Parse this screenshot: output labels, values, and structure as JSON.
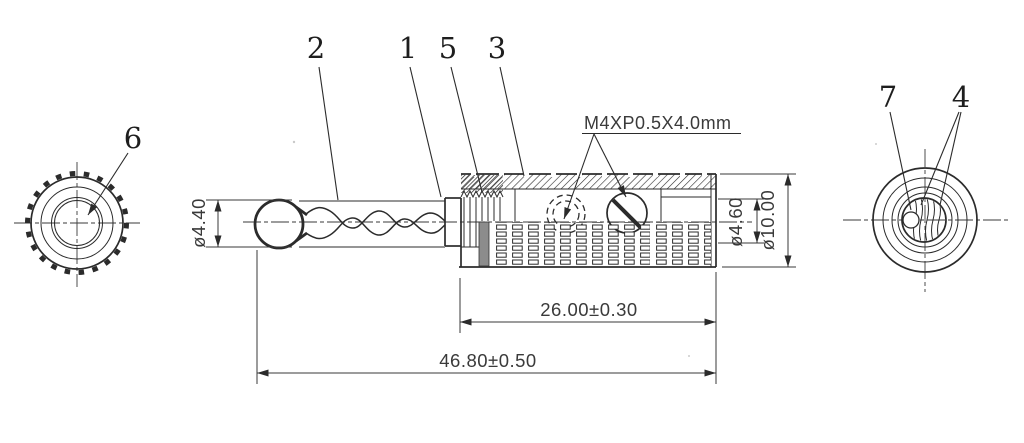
{
  "drawing": {
    "thread_spec": "M4XP0.5X4.0mm",
    "dimensions": {
      "tip_diameter": "ø4.40",
      "bore_diameter": "ø4.60",
      "body_diameter": "ø10.00",
      "insert_length": "26.00±0.30",
      "overall_length": "46.80±0.50"
    },
    "callouts": {
      "front_view": "6",
      "side_view": [
        "2",
        "1",
        "5",
        "3"
      ],
      "rear_view": [
        "7",
        "4"
      ]
    }
  }
}
